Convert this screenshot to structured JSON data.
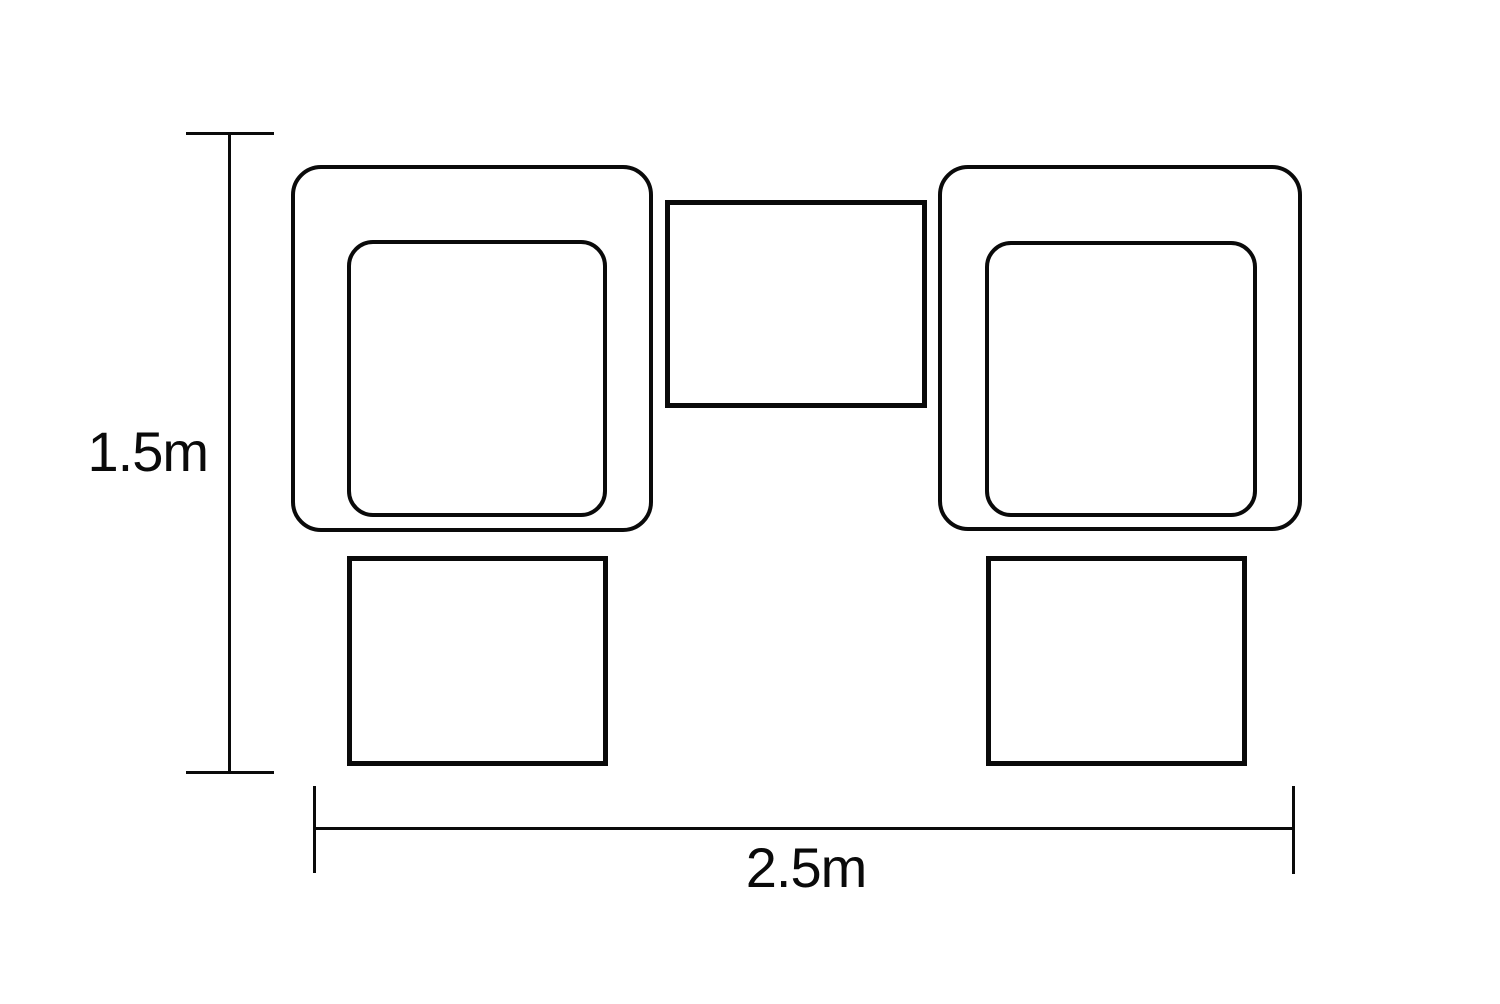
{
  "diagram": {
    "type": "furniture-set-plan-dimension-drawing",
    "labels": {
      "height": "1.5m",
      "width": "2.5m"
    },
    "colors": {
      "line": "#0a0a0a",
      "background": "#ffffff"
    }
  }
}
